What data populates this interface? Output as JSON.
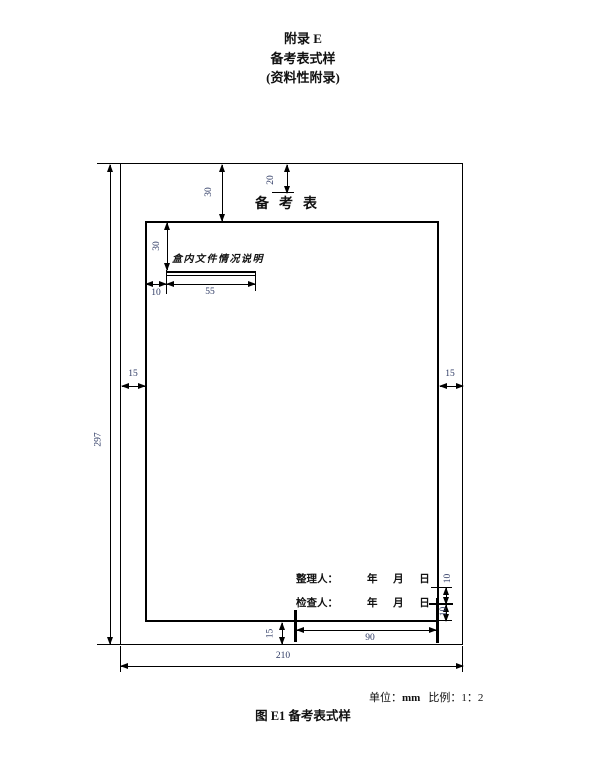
{
  "header": {
    "line1": "附录 E",
    "line2": "备考表式样",
    "line3": "(资料性附录)"
  },
  "figure": {
    "table_title": "备考表",
    "box_note_label": "盒内文件情况说明",
    "signers": [
      {
        "label": "整理人：",
        "date": "年 月 日"
      },
      {
        "label": "检查人：",
        "date": "年 月 日"
      }
    ],
    "dims": {
      "page_height": "297",
      "page_width": "210",
      "margin_left": "15",
      "margin_right": "15",
      "margin_bottom": "15",
      "top_to_frame": "30",
      "top_to_title": "20",
      "frame_to_label": "30",
      "label_indent": "10",
      "label_width": "55",
      "signature_width": "90",
      "row_gap_upper": "10",
      "row_gap_lower": "10"
    },
    "note": {
      "unit_label": "单位：",
      "unit_value": "mm",
      "scale_label": "比例：",
      "scale_value": "1：2"
    },
    "caption": "图 E1  备考表式样"
  },
  "colors": {
    "line": "#000000",
    "dimension_text": "#2e3a64"
  }
}
